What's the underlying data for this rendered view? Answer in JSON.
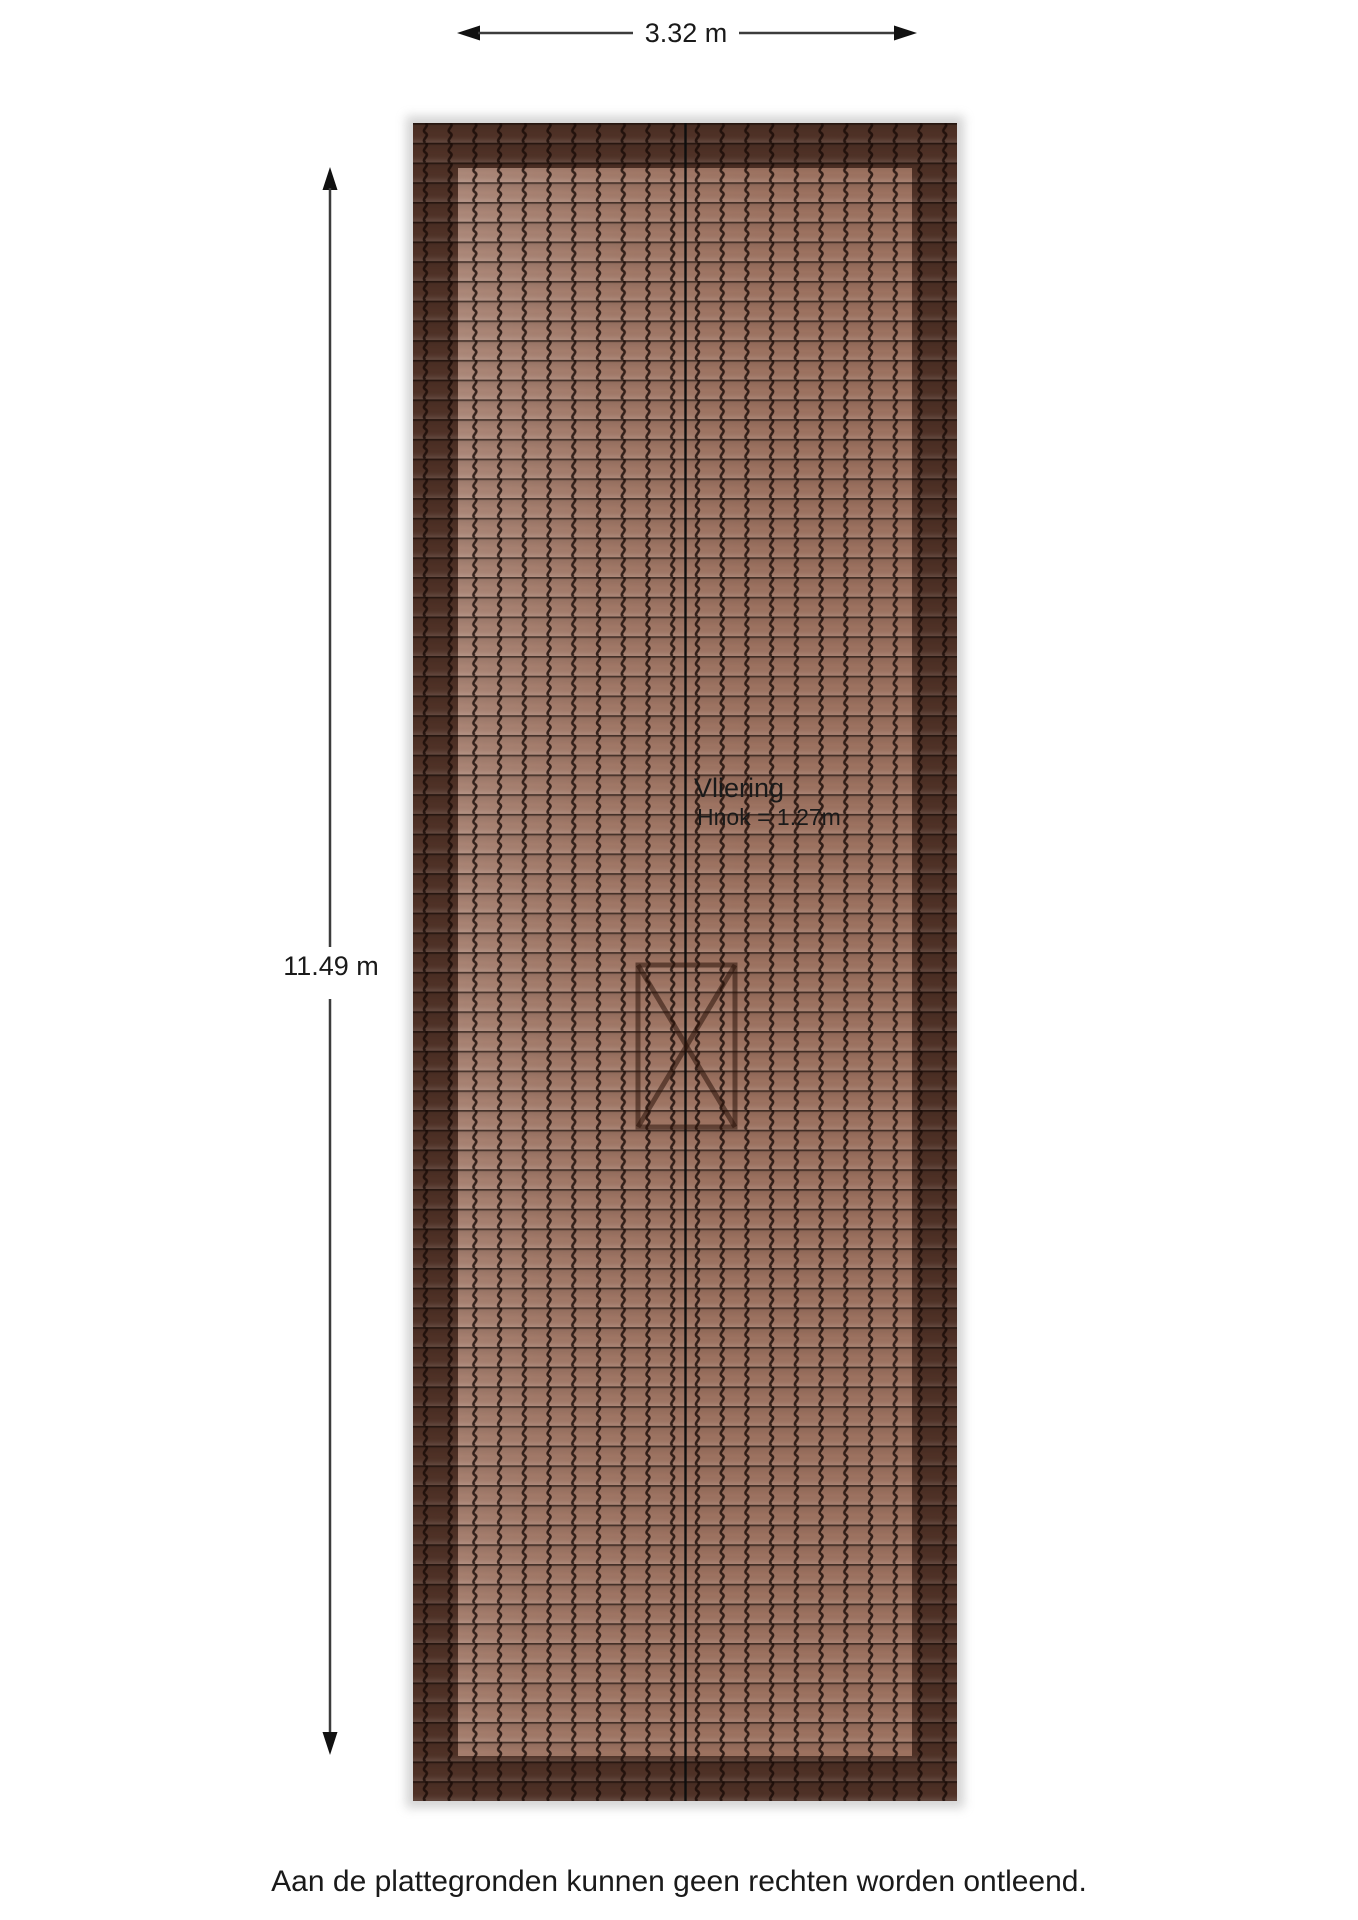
{
  "floorplan": {
    "room_label": "Vliering",
    "ridge_height_label": "Hnok = 1.27m",
    "width_dimension": "3.32 m",
    "height_dimension": "11.49 m"
  },
  "footer": {
    "disclaimer": "Aan de plattegronden kunnen geen rechten worden ontleend."
  },
  "colors": {
    "roof_border": "#4f3126",
    "roof_field": "#9d7260",
    "tile_line": "#1a0c06",
    "ridge_line": "#0e0e0e",
    "dimension_line": "#3c3c3c",
    "text": "#1a1a1a"
  }
}
